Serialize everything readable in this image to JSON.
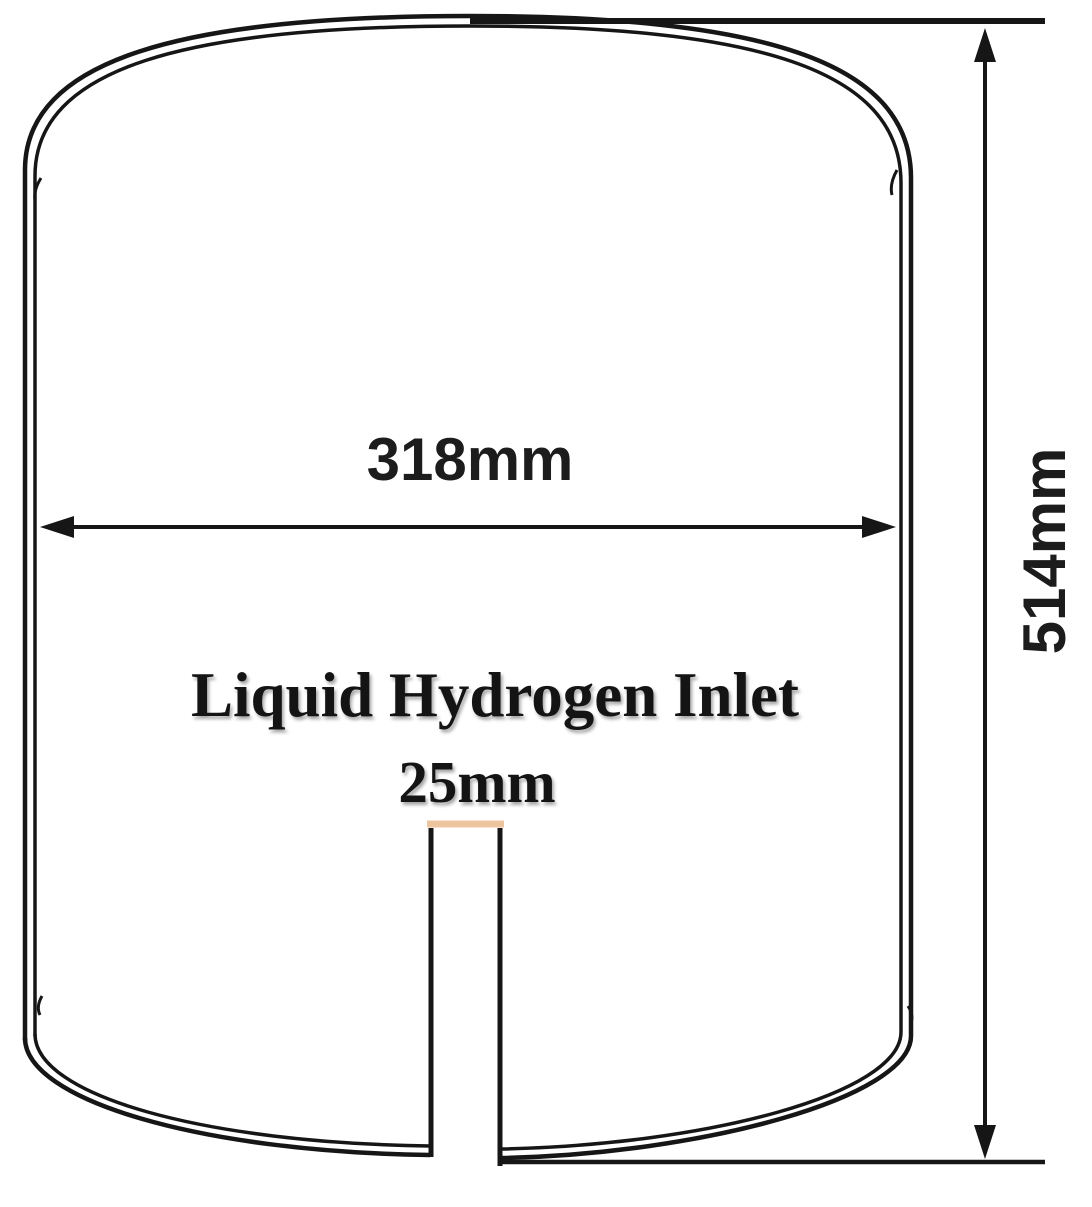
{
  "diagram": {
    "type": "technical-drawing",
    "subject": "cryogenic-tank-cross-section",
    "dimensions": {
      "width_label": "318mm",
      "height_label": "514mm",
      "inlet_width_label": "25mm"
    },
    "inlet": {
      "label": "Liquid Hydrogen Inlet"
    },
    "colors": {
      "line": "#161616",
      "inlet_highlight": "#ecc49f",
      "background": "#ffffff"
    }
  }
}
